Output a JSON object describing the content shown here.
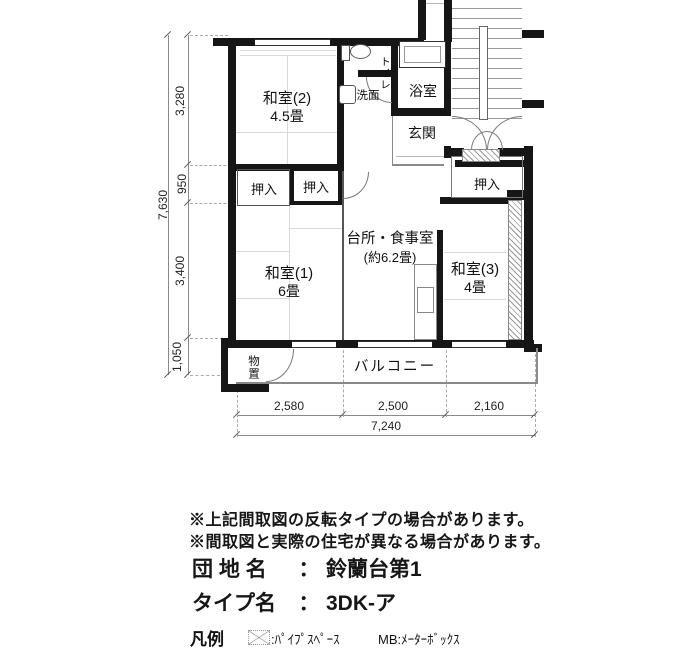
{
  "plan": {
    "rooms": {
      "washitsu2": {
        "name": "和室(2)",
        "size": "4.5畳"
      },
      "washitsu1": {
        "name": "和室(1)",
        "size": "6畳"
      },
      "washitsu3": {
        "name": "和室(3)",
        "size": "4畳"
      },
      "dk": {
        "name": "台所・食事室",
        "size": "(約6.2畳)"
      },
      "toilet": "トイレ",
      "senmen": "洗面",
      "bath": "浴室",
      "genkan": "玄関",
      "oshiire": "押入",
      "monooki": "物置",
      "balcony": "バルコニー"
    },
    "dims": {
      "left_total": "7,630",
      "left_seg1": "3,280",
      "left_seg2": "950",
      "left_seg3": "3,400",
      "left_seg4": "1,050",
      "bottom_seg1": "2,580",
      "bottom_seg2": "2,500",
      "bottom_seg3": "2,160",
      "bottom_total": "7,240"
    }
  },
  "notes": {
    "line1": "※上記間取図の反転タイプの場合があります。",
    "line2": "※間取図と実際の住宅が異なる場合があります。"
  },
  "info": {
    "estate_label": "団 地 名",
    "estate_sep": "：",
    "estate_value": "鈴蘭台第1",
    "type_label": "タイプ名",
    "type_sep": "：",
    "type_value": "3DK-ア"
  },
  "legend": {
    "title": "凡例",
    "ps": ":ﾊﾟｲﾌﾟｽﾍﾟｰｽ",
    "mb": "MB:ﾒｰﾀｰﾎﾞｯｸｽ"
  }
}
